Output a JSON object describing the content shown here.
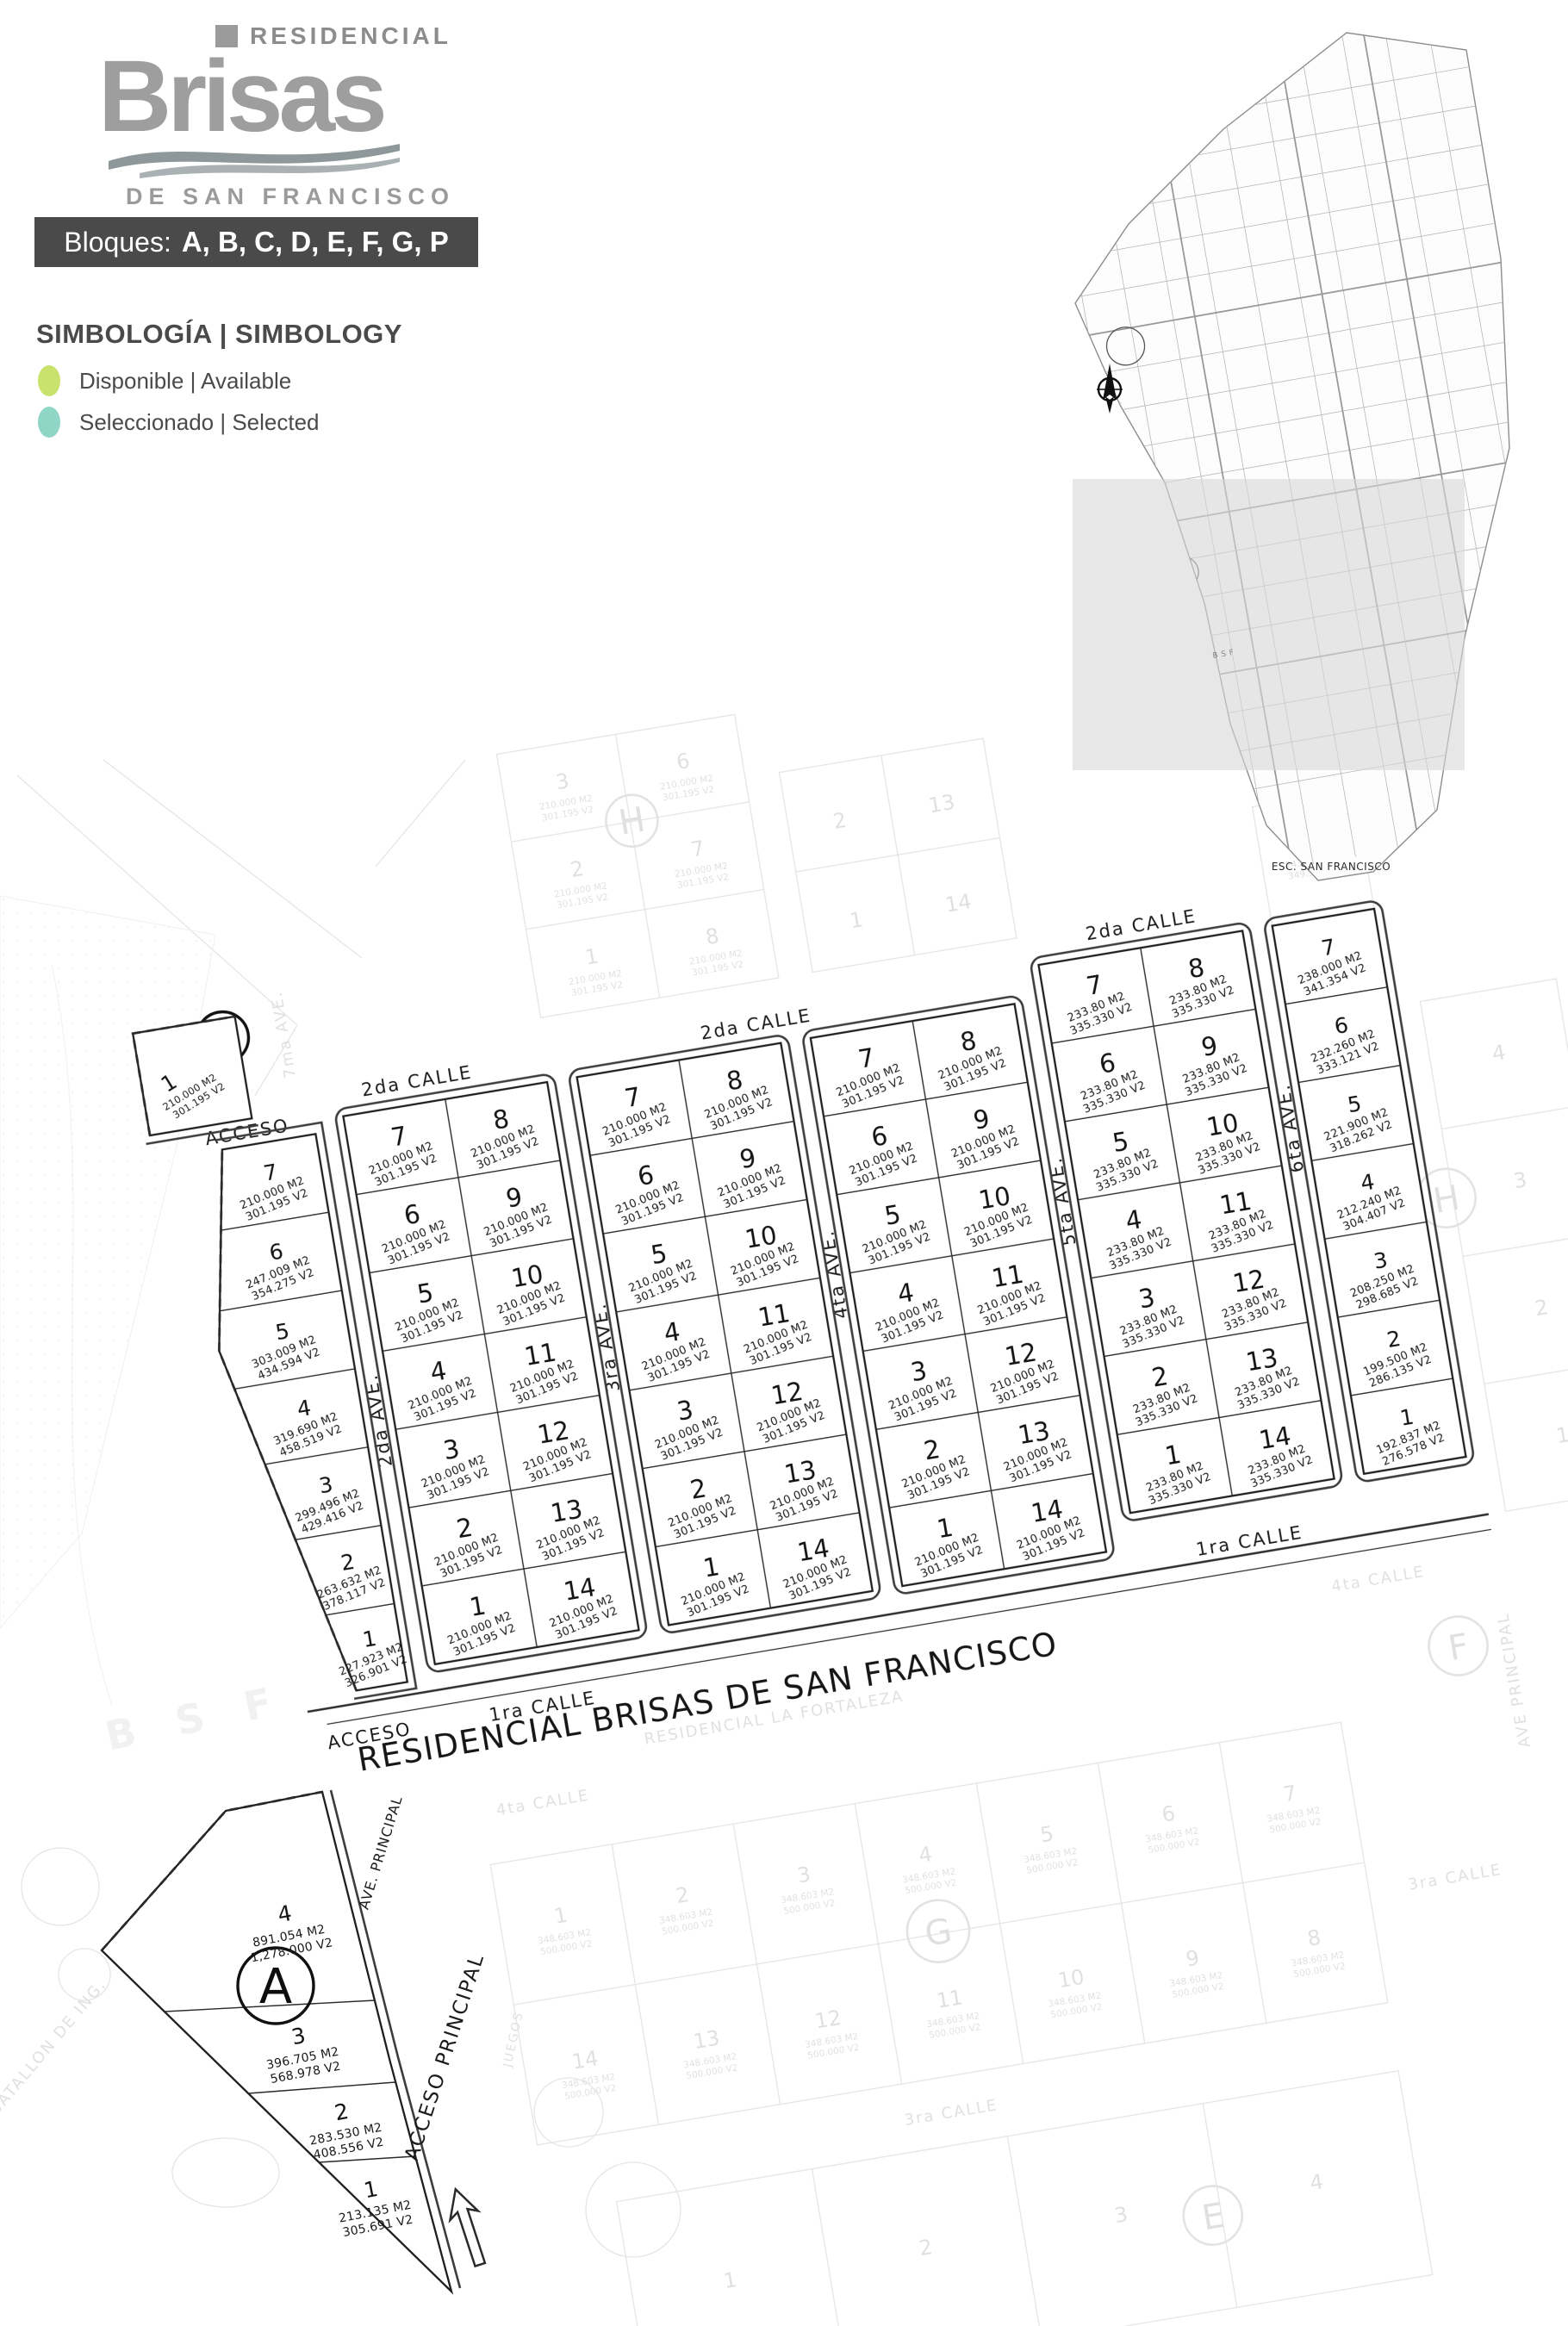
{
  "logo": {
    "residencial": "RESIDENCIAL",
    "brand": "Brisas",
    "subtitle": "DE SAN FRANCISCO"
  },
  "banner": {
    "prefix": "Bloques:",
    "list": "A, B, C, D, E, F, G, P"
  },
  "legend": {
    "title": "SIMBOLOGÍA | SIMBOLOGY",
    "items": [
      {
        "label": "Disponible | Available",
        "color": "#c9e26d"
      },
      {
        "label": "Seleccionado | Selected",
        "color": "#8fd6c7"
      }
    ]
  },
  "overview": {
    "caption": "ESC. SAN FRANCISCO"
  },
  "map": {
    "title": "RESIDENCIAL BRISAS DE SAN FRANCISCO",
    "streets": {
      "acceso": "ACCESO",
      "calle2": "2da CALLE",
      "calle1": "1ra CALLE",
      "ave2": "2da AVE.",
      "ave3": "3ra AVE.",
      "ave4": "4ta AVE.",
      "ave5": "5ta AVE.",
      "ave6": "6ta AVE.",
      "ave_principal": "AVE. PRINCIPAL",
      "acceso_principal": "ACCESO PRINCIPAL"
    },
    "blocks": [
      {
        "letter": "G",
        "lots": [
          {
            "n": "1",
            "m2": "210.000 M2",
            "v2": "301.195 V2"
          }
        ]
      },
      {
        "letter": "B",
        "lots": [
          {
            "n": "7",
            "m2": "210.000 M2",
            "v2": "301.195 V2"
          },
          {
            "n": "6",
            "m2": "247.009 M2",
            "v2": "354.275 V2"
          },
          {
            "n": "5",
            "m2": "303.009 M2",
            "v2": "434.594 V2"
          },
          {
            "n": "4",
            "m2": "319.690 M2",
            "v2": "458.519 V2"
          },
          {
            "n": "3",
            "m2": "299.496 M2",
            "v2": "429.416 V2"
          },
          {
            "n": "2",
            "m2": "263.632 M2",
            "v2": "378.117 V2"
          },
          {
            "n": "1",
            "m2": "227.923 M2",
            "v2": "326.901 V2"
          }
        ]
      },
      {
        "letter": "C",
        "m2": "210.000 M2",
        "v2": "301.195 V2",
        "left": [
          "7",
          "6",
          "5",
          "4",
          "3",
          "2",
          "1"
        ],
        "right": [
          "8",
          "9",
          "10",
          "11",
          "12",
          "13",
          "14"
        ]
      },
      {
        "letter": "D",
        "m2": "210.000 M2",
        "v2": "301.195 V2",
        "left": [
          "7",
          "6",
          "5",
          "4",
          "3",
          "2",
          "1"
        ],
        "right": [
          "8",
          "9",
          "10",
          "11",
          "12",
          "13",
          "14"
        ]
      },
      {
        "letter": "E",
        "m2": "210.000 M2",
        "v2": "301.195 V2",
        "left": [
          "7",
          "6",
          "5",
          "4",
          "3",
          "2",
          "1"
        ],
        "right": [
          "8",
          "9",
          "10",
          "11",
          "12",
          "13",
          "14"
        ]
      },
      {
        "letter": "F",
        "m2": "233.80 M2",
        "v2": "335.330 V2",
        "left": [
          "7",
          "6",
          "5",
          "4",
          "3",
          "2",
          "1"
        ],
        "right": [
          "8",
          "9",
          "10",
          "11",
          "12",
          "13",
          "14"
        ]
      },
      {
        "letter": "",
        "lots": [
          {
            "n": "7",
            "m2": "238.000 M2",
            "v2": "341.354 V2"
          },
          {
            "n": "6",
            "m2": "232.260 M2",
            "v2": "333.121 V2"
          },
          {
            "n": "5",
            "m2": "221.900 M2",
            "v2": "318.262 V2"
          },
          {
            "n": "4",
            "m2": "212.240 M2",
            "v2": "304.407 V2"
          },
          {
            "n": "3",
            "m2": "208.250 M2",
            "v2": "298.685 V2"
          },
          {
            "n": "2",
            "m2": "199.500 M2",
            "v2": "286.135 V2"
          },
          {
            "n": "1",
            "m2": "192.837 M2",
            "v2": "276.578 V2"
          }
        ]
      },
      {
        "letter": "A",
        "lots": [
          {
            "n": "4",
            "m2": "891.054 M2",
            "v2": "1,278.000 V2"
          },
          {
            "n": "3",
            "m2": "396.705 M2",
            "v2": "568.978 V2"
          },
          {
            "n": "2",
            "m2": "283.530 M2",
            "v2": "408.556 V2"
          },
          {
            "n": "1",
            "m2": "213.135 M2",
            "v2": "305.691 V2"
          }
        ]
      }
    ],
    "faded": {
      "fortaleza": "RESIDENCIAL LA FORTALEZA",
      "calle3": "3ra CALLE",
      "calle4": "4ta CALLE",
      "ave7": "7ma AVE.",
      "ave_principal": "AVE PRINCIPAL",
      "batallon": "BATALLON DE ING.",
      "bsf": "B S F",
      "juegos": "JUEGOS",
      "m2_210": "210.000 M2",
      "v2_301": "301.195 V2",
      "h_block": {
        "letter": "H",
        "left": [
          "3",
          "2",
          "1"
        ],
        "right": [
          "6",
          "7",
          "8"
        ]
      },
      "d_above": {
        "left": [
          "2",
          "1"
        ],
        "right": [
          "13",
          "14"
        ]
      },
      "p_above": {
        "n": "8",
        "m2": "243.600 M2",
        "v2": "349.389 V2"
      },
      "east": {
        "letter": "H",
        "nums": [
          "4",
          "3",
          "2",
          "1"
        ]
      },
      "f_letter": "F",
      "g_grid": {
        "letter": "G",
        "top": [
          "1",
          "2",
          "3",
          "4",
          "5",
          "6",
          "7"
        ],
        "bottom": [
          "14",
          "13",
          "12",
          "11",
          "10",
          "9",
          "8"
        ],
        "m2": "348.603 M2",
        "v2": "500.000 V2"
      },
      "low": {
        "letter": "E",
        "nums": [
          "1",
          "2",
          "3",
          "4"
        ]
      }
    }
  }
}
